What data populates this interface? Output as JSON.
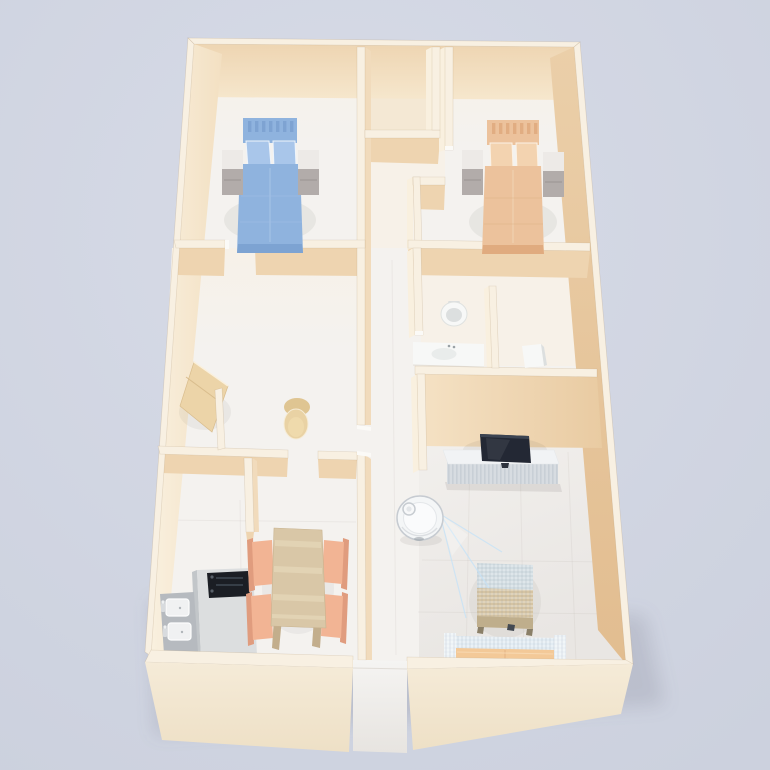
{
  "title": "",
  "scene": {
    "type": "3d-isometric-floor-plan-render",
    "rooms": [
      {
        "name": "bedroom-left",
        "furniture": [
          "blue-double-bed",
          "headboard",
          "two-pillows",
          "nightstand-left",
          "nightstand-right"
        ]
      },
      {
        "name": "bedroom-right",
        "furniture": [
          "peach-double-bed",
          "headboard",
          "two-pillows",
          "nightstand-left",
          "nightstand-right"
        ]
      },
      {
        "name": "closet",
        "furniture": []
      },
      {
        "name": "bathroom",
        "furniture": [
          "round-toilet-top-view",
          "vanity-sink",
          "partition-wall",
          "small-fixture"
        ]
      },
      {
        "name": "study",
        "furniture": [
          "angled-desk",
          "round-chair",
          "partition-stub"
        ]
      },
      {
        "name": "kitchen",
        "furniture": [
          "l-shaped-counter",
          "black-cooktop",
          "double-basin-sink"
        ]
      },
      {
        "name": "dining",
        "furniture": [
          "wood-table",
          "salmon-chair-1",
          "salmon-chair-2",
          "salmon-chair-3",
          "salmon-chair-4"
        ]
      },
      {
        "name": "living-room",
        "furniture": [
          "tv-console",
          "flat-tv",
          "coffee-table",
          "sofa",
          "robot-vacuum",
          "lidar-beam"
        ]
      },
      {
        "name": "hallway",
        "furniture": [
          "entrance-doorway"
        ]
      }
    ],
    "robot": {
      "state": "scanning",
      "beam_direction": "lower-right"
    }
  },
  "colors": {
    "background": "#ccd1de",
    "background_light": "#d7dbe7",
    "wall_top": "#f8f0e2",
    "wall_face_south": "#eed4b0",
    "wall_face_south_light": "#f3e0c2",
    "wall_face_east": "#f1dbbc",
    "wall_face_west_lit": "#f9f0df",
    "wall_face_inner_right_a": "#ebcfa9",
    "wall_face_inner_right_b": "#e2bd90",
    "wall_face_north_a": "#eed5b2",
    "wall_face_north_b": "#f6e7cd",
    "wall_h4_a": "#f5e2c5",
    "wall_h4_b": "#e9cba2",
    "wall_front_a": "#f5ebd8",
    "wall_front_b": "#eee0c6",
    "floor": "#f4f2ef",
    "floor_warm": "#f7f1e8",
    "floor_living_b": "#e9e6e3",
    "closet_floor": "#f4e8d4",
    "entry_a": "#f5f4f2",
    "entry_b": "#e7e4e0",
    "bed_blue": "#8fb3de",
    "bed_blue_dark": "#7aa0d0",
    "bed_blue_light": "#a9c6ea",
    "bed_peach": "#ecc29c",
    "bed_peach_dark": "#dfa87c",
    "bed_peach_light": "#f3d3b0",
    "nightstand_top": "#edeae7",
    "nightstand_face": "#b2acaa",
    "desk_wood": "#ecd4a8",
    "chair_wood": "#e9d2a4",
    "table_wood": "#d9c7a7",
    "table_wood_dark": "#c3ae8c",
    "chair_salmon": "#f2b494",
    "chair_salmon_dark": "#e09c7e",
    "counter_top": "#dcdedf",
    "counter_face": "#c2c6c9",
    "cooktop": "#1b1e24",
    "sink_metal": "#b6babf",
    "sink_white": "#f0f1f2",
    "fixture_white": "#f7f8f7",
    "fixture_shade": "#dcdfdf",
    "console_top": "#f1f3f5",
    "console_face": "#d7dce1",
    "console_slat": "#c6cdd4",
    "tv_screen": "#232834",
    "tv_edge": "#3c4452",
    "robot_body": "#f4f6f7",
    "robot_ring": "#c6cbd1",
    "robot_inner": "#fafbfc",
    "beam": "#78b4e8",
    "beam_bright": "#c4e2f8",
    "coffee_top_blue": "#d2dde2",
    "coffee_wood": "#d5c4a3",
    "coffee_wood_dark": "#bfae8c",
    "sofa_seat": "#f3c998",
    "sofa_back": "#e2ecf3",
    "sofa_arm": "#ecf2f6",
    "shadow": "rgba(100,95,90,0.16)",
    "building_shadow": "rgba(88,92,110,0.30)"
  }
}
